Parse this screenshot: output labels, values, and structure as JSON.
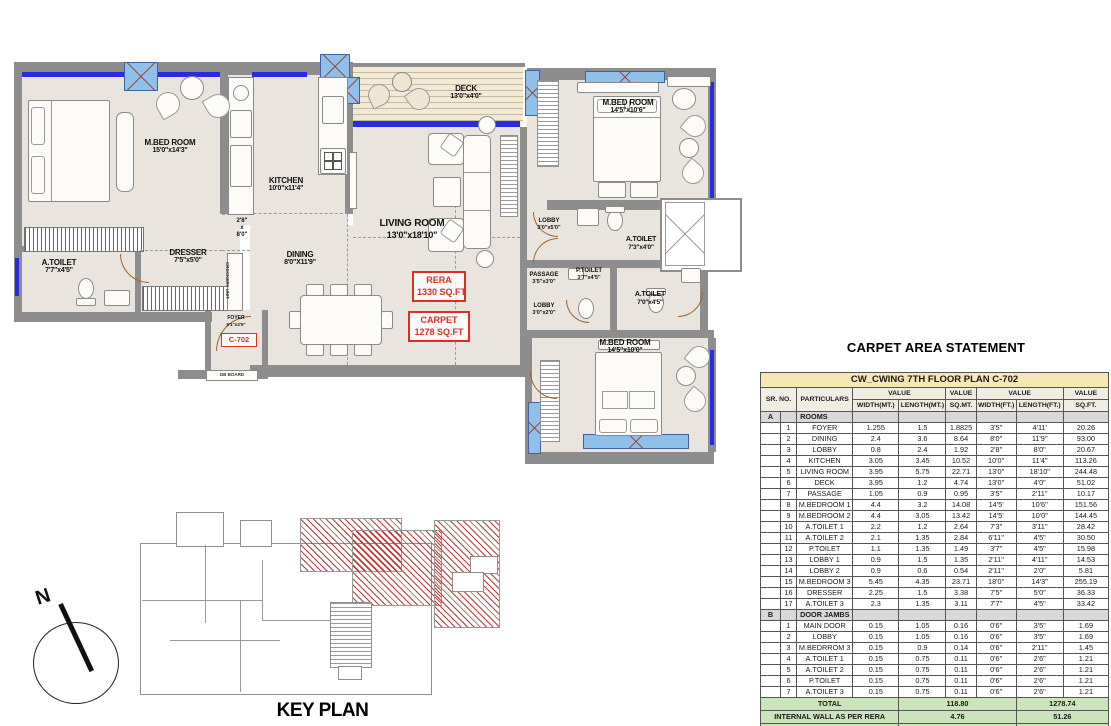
{
  "plan": {
    "rooms": [
      {
        "name": "M.BED ROOM",
        "dim": "15'0\"x14'3\""
      },
      {
        "name": "KITCHEN",
        "dim": "10'0\"x11'4\""
      },
      {
        "name": "A.TOILET",
        "dim": "7'7\"x4'5\""
      },
      {
        "name": "DRESSER",
        "dim": "7'5\"x5'0\""
      },
      {
        "name": "DINING",
        "dim": "8'0\"X11'9\""
      },
      {
        "name": "LIVING ROOM",
        "dim": "13'0\"x18'10\""
      },
      {
        "name": "DECK",
        "dim": "13'0\"x4'0\""
      },
      {
        "name": "M.BED ROOM",
        "dim": "14'5\"x10'6\""
      },
      {
        "name": "LOBBY",
        "dim": "3'0\"x5'0\""
      },
      {
        "name": "A.TOILET",
        "dim": "7'3\"x4'0\""
      },
      {
        "name": "PASSAGE",
        "dim": "3'5\"x3'0\""
      },
      {
        "name": "P.TOILET",
        "dim": "3'7\"x4'5\""
      },
      {
        "name": "LOBBY",
        "dim": "3'0\"x2'0\""
      },
      {
        "name": "A.TOILET",
        "dim": "7'0\"x4'5\""
      },
      {
        "name": "M.BED ROOM",
        "dim": "14'5\"x10'0\""
      },
      {
        "name": "FOYER",
        "dim": "5'1\"x3'5\""
      }
    ],
    "shaft_label": {
      "l1": "2'8\"",
      "l2": "x",
      "l3": "8'0\""
    },
    "crockery_unit": "CROCKERY UNIT",
    "db_board": "DB BOARD",
    "unit_no": "C-702",
    "rera_box": {
      "l1": "RERA",
      "l2": "1330 SQ.FT"
    },
    "carpet_box": {
      "l1": "CARPET",
      "l2": "1278 SQ.FT"
    },
    "north": "N",
    "key_plan_title": "KEY PLAN"
  },
  "table": {
    "title": "CARPET AREA STATEMENT",
    "subtitle": "CW_CWING 7TH FLOOR PLAN C-702",
    "col_headers": {
      "sr_no": "SR. NO.",
      "particulars": "PARTICULARS",
      "value": "VALUE",
      "width_mt": "WIDTH(MT.)",
      "length_mt": "LENGTH(MT.)",
      "sq_mt": "SQ.MT.",
      "width_ft": "WIDTH(FT.)",
      "length_ft": "LENGTH(FT.)",
      "sq_ft": "SQ.FT."
    },
    "sections": [
      {
        "id": "A",
        "title": "ROOMS",
        "rows": [
          [
            "1",
            "FOYER",
            "1.255",
            "1.5",
            "1.8825",
            "3'5\"",
            "4'11'",
            "20.26"
          ],
          [
            "2",
            "DINING",
            "2.4",
            "3.6",
            "8.64",
            "8'0\"",
            "11'9''",
            "93.00"
          ],
          [
            "3",
            "LOBBY",
            "0.8",
            "2.4",
            "1.92",
            "2'8\"",
            "8'0\"",
            "20.67"
          ],
          [
            "4",
            "KITCHEN",
            "3.05",
            "3.45",
            "10.52",
            "10'0\"",
            "11'4\"",
            "113.26"
          ],
          [
            "5",
            "LIVING ROOM",
            "3.95",
            "5.75",
            "22.71",
            "13'0\"",
            "18'10\"",
            "244.48"
          ],
          [
            "6",
            "DECK",
            "3.95",
            "1.2",
            "4.74",
            "13'0\"",
            "4'0\"",
            "51.02"
          ],
          [
            "7",
            "PASSAGE",
            "1.05",
            "0.9",
            "0.95",
            "3'5\"",
            "2'11''",
            "10.17"
          ],
          [
            "8",
            "M.BEDROOM 1",
            "4.4",
            "3.2",
            "14.08",
            "14'5'",
            "10'6''",
            "151.56"
          ],
          [
            "9",
            "M.BEDROOM 2",
            "4.4",
            "3.05",
            "13.42",
            "14'5'",
            "10'0\"",
            "144.45"
          ],
          [
            "10",
            "A.TOILET 1",
            "2.2",
            "1.2",
            "2.64",
            "7'3\"",
            "3'11''",
            "28.42"
          ],
          [
            "11",
            "A.TOILET 2",
            "2.1",
            "1.35",
            "2.84",
            "6'11''",
            "4'5\"",
            "30.50"
          ],
          [
            "12",
            "P.TOILET",
            "1.1",
            "1.35",
            "1.49",
            "3'7\"",
            "4'5\"",
            "15.98"
          ],
          [
            "13",
            "LOBBY 1",
            "0.9",
            "1.5",
            "1.35",
            "2'11''",
            "4'11''",
            "14.53"
          ],
          [
            "14",
            "LOBBY 2",
            "0.9",
            "0.6",
            "0.54",
            "2'11''",
            "2'0\"",
            "5.81"
          ],
          [
            "15",
            "M.BEDROOM 3",
            "5.45",
            "4.35",
            "23.71",
            "18'0\"",
            "14'3\"",
            "255.19"
          ],
          [
            "16",
            "DRESSER",
            "2.25",
            "1.5",
            "3.38",
            "7'5\"",
            "5'0\"",
            "36.33"
          ],
          [
            "17",
            "A.TOILET 3",
            "2.3",
            "1.35",
            "3.11",
            "7'7\"",
            "4'5\"",
            "33.42"
          ]
        ]
      },
      {
        "id": "B",
        "title": "DOOR JAMBS",
        "rows": [
          [
            "1",
            "MAIN DOOR",
            "0.15",
            "1.05",
            "0.16",
            "0'6\"",
            "3'5\"",
            "1.69"
          ],
          [
            "2",
            "LOBBY",
            "0.15",
            "1.05",
            "0.16",
            "0'6\"",
            "3'5\"",
            "1.69"
          ],
          [
            "3",
            "M.BEDRROM 3",
            "0.15",
            "0.9",
            "0.14",
            "0'6\"",
            "2'11''",
            "1.45"
          ],
          [
            "4",
            "A.TOILET 1",
            "0.15",
            "0.75",
            "0.11",
            "0'6\"",
            "2'6\"",
            "1.21"
          ],
          [
            "5",
            "A.TOILET 2",
            "0.15",
            "0.75",
            "0.11",
            "0'6\"",
            "2'6\"",
            "1.21"
          ],
          [
            "6",
            "P.TOILET",
            "0.15",
            "0.75",
            "0.11",
            "0'6\"",
            "2'6\"",
            "1.21"
          ],
          [
            "7",
            "A.TOILET 3",
            "0.15",
            "0.75",
            "0.11",
            "0'6\"",
            "2'6\"",
            "1.21"
          ]
        ]
      }
    ],
    "totals": [
      {
        "label": "TOTAL",
        "mt": "118.80",
        "ft": "1278.74"
      },
      {
        "label": "INTERNAL WALL AS PER RERA",
        "mt": "4.76",
        "ft": "51.26"
      },
      {
        "label": "RERA AREA",
        "mt": "123.56",
        "ft": "1330"
      }
    ]
  }
}
